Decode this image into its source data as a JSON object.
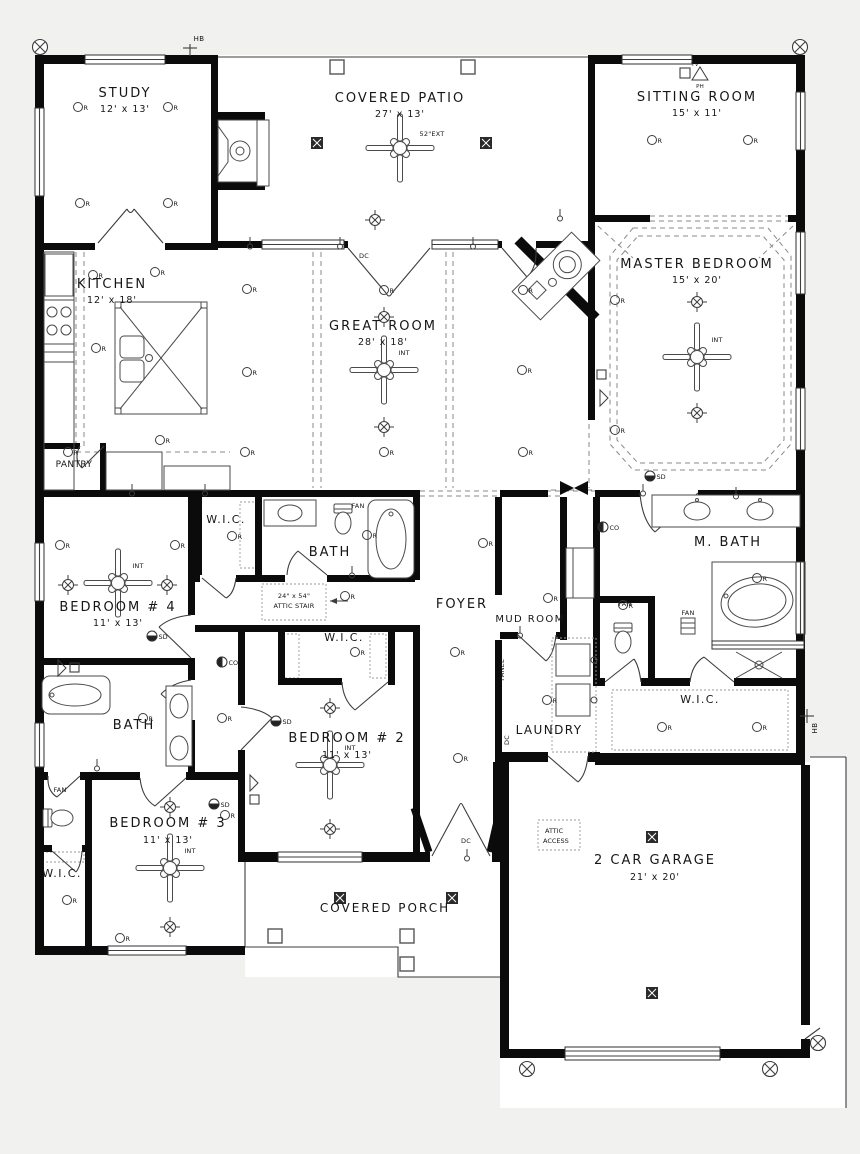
{
  "colors": {
    "background": "#f1f1ef",
    "wall": "#0b0b0b",
    "line": "#3c3c3c",
    "dash": "#8a8a8a",
    "text": "#161616"
  },
  "rooms": [
    {
      "name": "STUDY",
      "dims": "12' x 13'"
    },
    {
      "name": "COVERED PATIO",
      "dims": "27' x 13'"
    },
    {
      "name": "SITTING ROOM",
      "dims": "15' x 11'"
    },
    {
      "name": "KITCHEN",
      "dims": "12' x 18'"
    },
    {
      "name": "GREAT ROOM",
      "dims": "28' x 18'"
    },
    {
      "name": "MASTER BEDROOM",
      "dims": "15' x 20'"
    },
    {
      "name": "PANTRY"
    },
    {
      "name": "BEDROOM # 4",
      "dims": "11' x 13'"
    },
    {
      "name": "W.I.C."
    },
    {
      "name": "BATH"
    },
    {
      "name": "FOYER"
    },
    {
      "name": "MUD ROOM"
    },
    {
      "name": "M. BATH"
    },
    {
      "name": "LAUNDRY"
    },
    {
      "name": "W.I.C."
    },
    {
      "name": "W.I.C."
    },
    {
      "name": "BATH"
    },
    {
      "name": "BEDROOM # 2",
      "dims": "11' x 13'"
    },
    {
      "name": "BEDROOM # 3",
      "dims": "11' x 13'"
    },
    {
      "name": "W.I.C."
    },
    {
      "name": "COVERED PORCH"
    },
    {
      "name": "2 CAR GARAGE",
      "dims": "21' x 20'"
    }
  ],
  "annotations": {
    "hb": "HB",
    "fan_int": "INT",
    "fan_ext": "52\"EXT",
    "stair1": "24\" x 54\"",
    "stair2": "ATTIC STAIR",
    "access1": "ATTIC",
    "access2": "ACCESS",
    "panel": "PANEL",
    "dc": "DC",
    "receptacle": "R",
    "smoke": "SD",
    "carbon": "CO",
    "tv": "TV",
    "phone": "PH",
    "fan": "FAN",
    "shower_light": "DL"
  }
}
